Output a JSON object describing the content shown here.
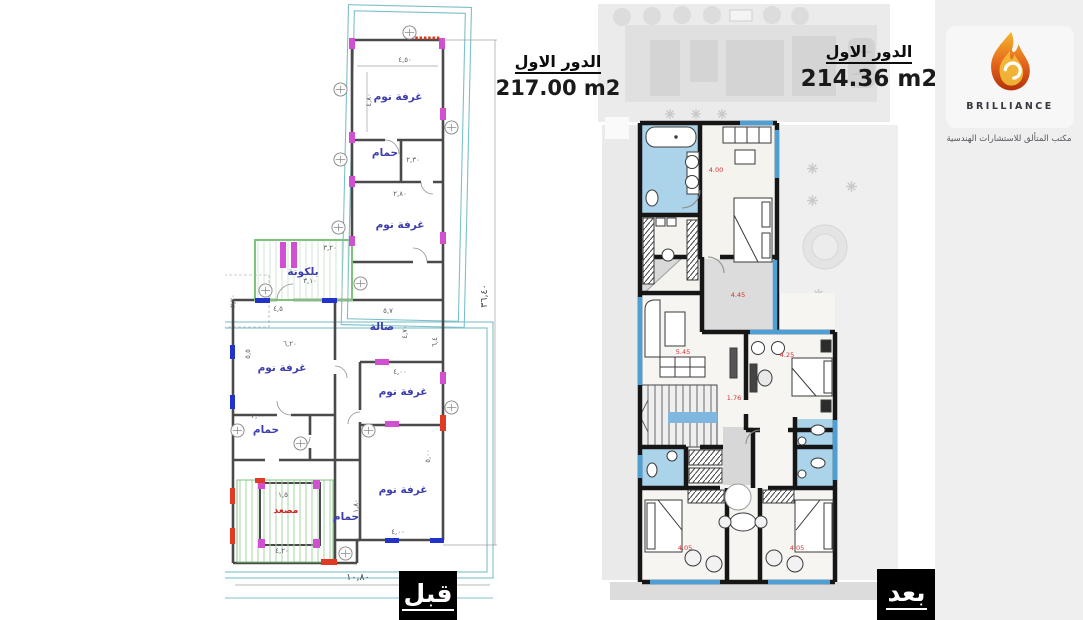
{
  "left_panel": {
    "title": "الدور الاول",
    "area": "217.00 m2",
    "tag": "قبل",
    "room_labels": {
      "bedroom_top": "غرفة نوم",
      "bath_top": "حمام",
      "bedroom_2": "غرفة نوم",
      "balcony": "بلكونة",
      "hall": "صالة",
      "bedroom_left": "غرفة نوم",
      "bedroom_mid": "غرفة نوم",
      "bath_left": "حمام",
      "bedroom_bottom": "غرفة نوم",
      "elevator": "مصعد",
      "bath_mid": "حمام"
    },
    "dims": {
      "total_height": "٣٦,٤٠",
      "total_width": "١٠,٨٠",
      "d1": "٤,٥٠",
      "d2": "٤,٨٠",
      "d3": "٢,٣٠",
      "d4": "٢,٨٠",
      "d5": "٣,٢٠",
      "d6": "٣,١٠",
      "d7": "٤,٥",
      "d8": "٥,٧",
      "d9": "٤,٧٠",
      "d10": "٦,٤",
      "d11": "٥,٥",
      "d12": "٢,٠٠",
      "d13": "٤,٠٠",
      "d14": "٥,٠٠",
      "d15": "٤,٠٠",
      "d16": "١,٨٠",
      "d17": "٤,٢٠",
      "d18": "١,٥",
      "d19": "٦,٢٠",
      "d20": "٢,٧٠"
    }
  },
  "right_panel": {
    "title": "الدور الاول",
    "area": "214.36 m2",
    "tag": "بعد",
    "dims": {
      "r1": "4.00",
      "r2": "4.45",
      "r3": "5.45",
      "r4": "4.25",
      "r5": "1.76",
      "r6": "4.05",
      "r7": "4.05"
    }
  },
  "logo": {
    "brand": "BRILLIANCE",
    "caption": "مكتب المتألق للاستشارات الهندسية"
  },
  "colors": {
    "cad_wall": "#4a4a4a",
    "boundary_teal": "#7cc0c9",
    "label_blue": "#3d3dae",
    "magenta": "#d14fd1",
    "window_blue": "#2233cc",
    "marker_red": "#e03a25",
    "stair_green": "#8fd08f",
    "render_wall": "#161616",
    "wet_area_blue": "#abd4eb",
    "glazing_blue": "#4f9fd4",
    "site_gray": "#e6e6e6",
    "flame_orange": "#e4641c"
  }
}
